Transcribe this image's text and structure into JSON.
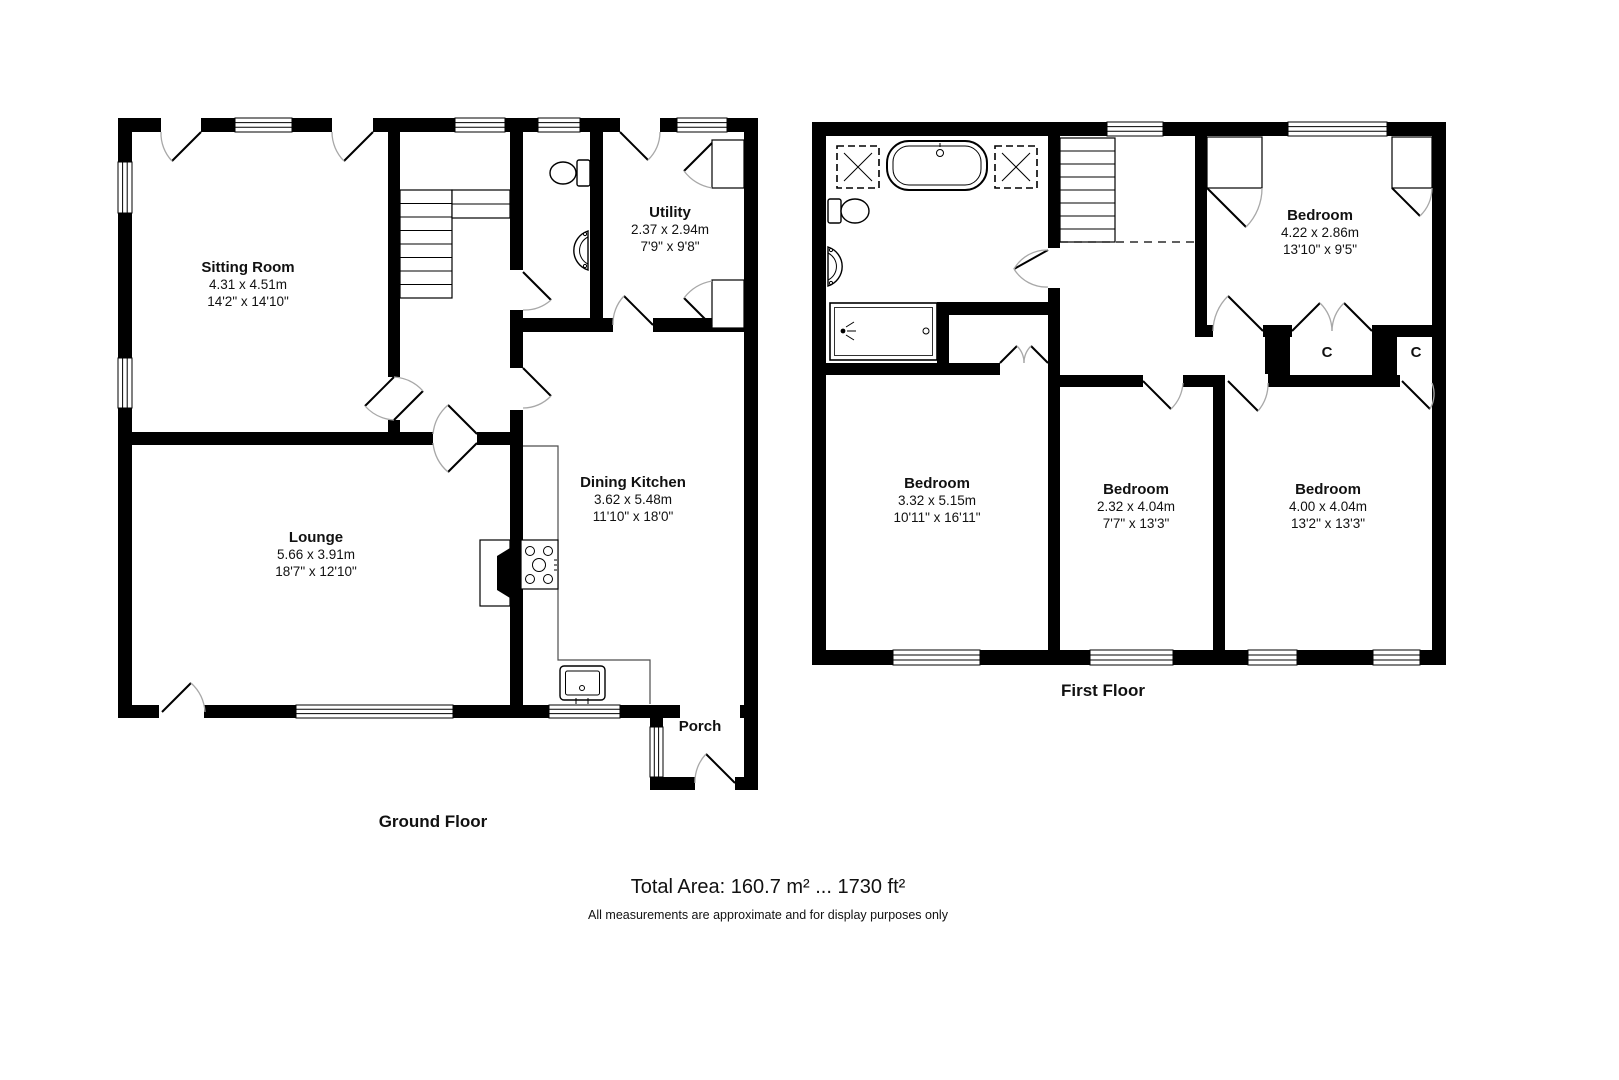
{
  "meta": {
    "background_color": "#ffffff",
    "wall_color": "#000000",
    "door_arc_color": "#a8a8a8"
  },
  "ground_floor": {
    "title": "Ground Floor",
    "rooms": [
      {
        "name": "Sitting Room",
        "metric": "4.31 x 4.51m",
        "imperial": "14'2\" x 14'10\""
      },
      {
        "name": "Utility",
        "metric": "2.37 x 2.94m",
        "imperial": "7'9\" x 9'8\""
      },
      {
        "name": "Dining Kitchen",
        "metric": "3.62 x 5.48m",
        "imperial": "11'10\" x 18'0\""
      },
      {
        "name": "Lounge",
        "metric": "5.66 x 3.91m",
        "imperial": "18'7\" x 12'10\""
      },
      {
        "name": "Porch",
        "metric": "",
        "imperial": ""
      }
    ]
  },
  "first_floor": {
    "title": "First Floor",
    "closet_label": "C",
    "rooms": [
      {
        "name": "Bedroom",
        "metric": "4.22 x 2.86m",
        "imperial": "13'10\" x 9'5\""
      },
      {
        "name": "Bedroom",
        "metric": "3.32 x 5.15m",
        "imperial": "10'11\" x 16'11\""
      },
      {
        "name": "Bedroom",
        "metric": "2.32 x 4.04m",
        "imperial": "7'7\" x 13'3\""
      },
      {
        "name": "Bedroom",
        "metric": "4.00 x 4.04m",
        "imperial": "13'2\" x 13'3\""
      }
    ]
  },
  "footer": {
    "total_area": "Total Area: 160.7 m² ... 1730 ft²",
    "disclaimer": "All measurements are approximate and for display purposes only"
  }
}
